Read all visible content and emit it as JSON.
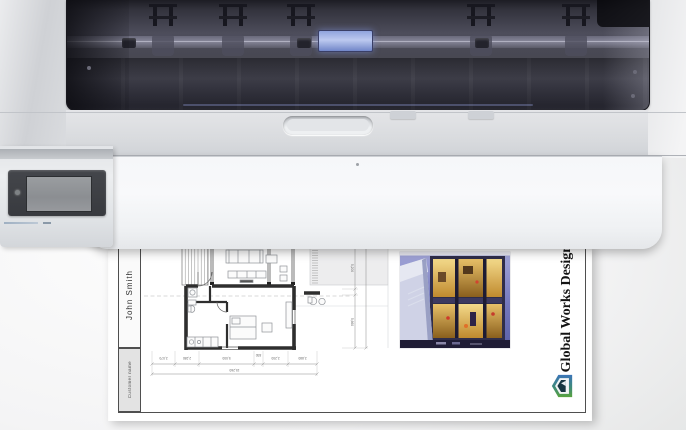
{
  "printer": {
    "description": "large-format inkjet printer, top view, printing",
    "control_panel": {
      "type": "touchscreen",
      "screen_content": ""
    }
  },
  "paper": {
    "title_block": {
      "customer_value": "John Smith",
      "customer_label": "Customer name"
    },
    "company_name": "Global Works Design",
    "plan": {
      "dim_bottom": [
        "2,070",
        "2,280",
        "5,000",
        "830",
        "2,200",
        "2,880"
      ],
      "dim_bottom_total": "15,260",
      "dim_right": [
        "5,200",
        "5,660"
      ]
    }
  },
  "colors": {
    "carriage_accent": "#9db0e4",
    "cover_tint": "#45454f",
    "logo_blue": "#3b74b8",
    "logo_green": "#58a33e",
    "photo_sky": "#8d91c8"
  },
  "icons": {
    "company_logo": "global-works-logo"
  }
}
